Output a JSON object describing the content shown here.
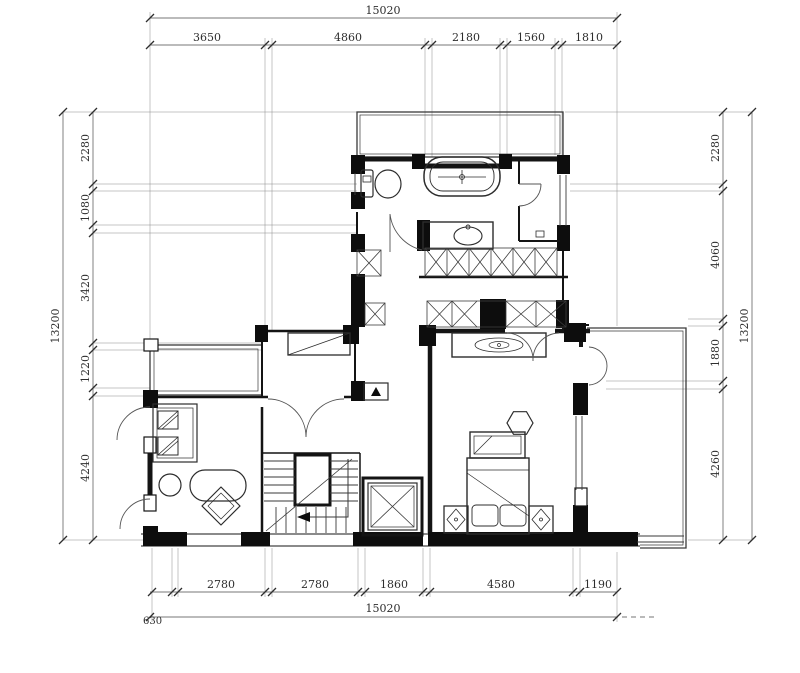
{
  "drawing": {
    "type": "residential floor plan",
    "units": "mm",
    "colors": {
      "ink": "#141414",
      "dim_text": "#2e2e2e",
      "background": "#ffffff"
    }
  },
  "dims": {
    "top": {
      "total": "15020",
      "segments": [
        "3650",
        "4860",
        "2180",
        "1560",
        "1810"
      ]
    },
    "bottom": {
      "total": "15020",
      "left_offset": "630",
      "segments": [
        "2780",
        "2780",
        "1860",
        "4580",
        "1190"
      ]
    },
    "left": {
      "total": "13200",
      "segments": [
        "2280",
        "1080",
        "3420",
        "1220",
        "4240"
      ]
    },
    "right": {
      "total": "13200",
      "segments": [
        "2280",
        "4060",
        "1880",
        "4260"
      ]
    }
  }
}
